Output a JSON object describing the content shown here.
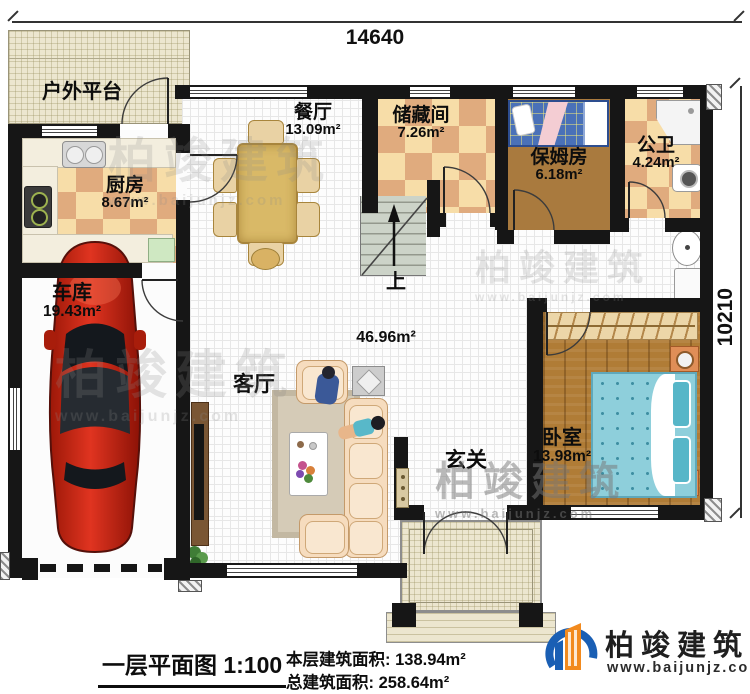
{
  "dimensions": {
    "top": "14640",
    "right": "10210"
  },
  "rooms": {
    "outdoor_platform": {
      "name": "户外平台"
    },
    "kitchen": {
      "name": "厨房",
      "area": "8.67m²"
    },
    "dining": {
      "name": "餐厅",
      "area": "13.09m²"
    },
    "storage": {
      "name": "储藏间",
      "area": "7.26m²"
    },
    "nanny_room": {
      "name": "保姆房",
      "area": "6.18m²"
    },
    "public_bath": {
      "name": "公卫",
      "area": "4.24m²"
    },
    "garage": {
      "name": "车库",
      "area": "19.43m²"
    },
    "living": {
      "name": "客厅",
      "area": "46.96m²"
    },
    "foyer": {
      "name": "玄关"
    },
    "bedroom": {
      "name": "卧室",
      "area": "13.98m²"
    },
    "stairs": {
      "direction_label": "上"
    }
  },
  "footer": {
    "title": "一层平面图",
    "scale": "1:100",
    "floor_area_label": "本层建筑面积:",
    "floor_area_value": "138.94m²",
    "total_area_label": "总建筑面积:",
    "total_area_value": "258.64m²"
  },
  "brand": {
    "name": "柏竣建筑",
    "website": "www.baijunjz.com"
  },
  "watermark": {
    "text": "柏竣建筑",
    "website": "www.baijunjz.com"
  },
  "colors": {
    "wall": "#161616",
    "tile_light": "#f7dda8",
    "tile_dark": "#e0ab7e",
    "wood": "#b07c36",
    "car_red": "#c22414",
    "brand_blue": "#1a5fb4",
    "brand_orange": "#f28a1e"
  }
}
